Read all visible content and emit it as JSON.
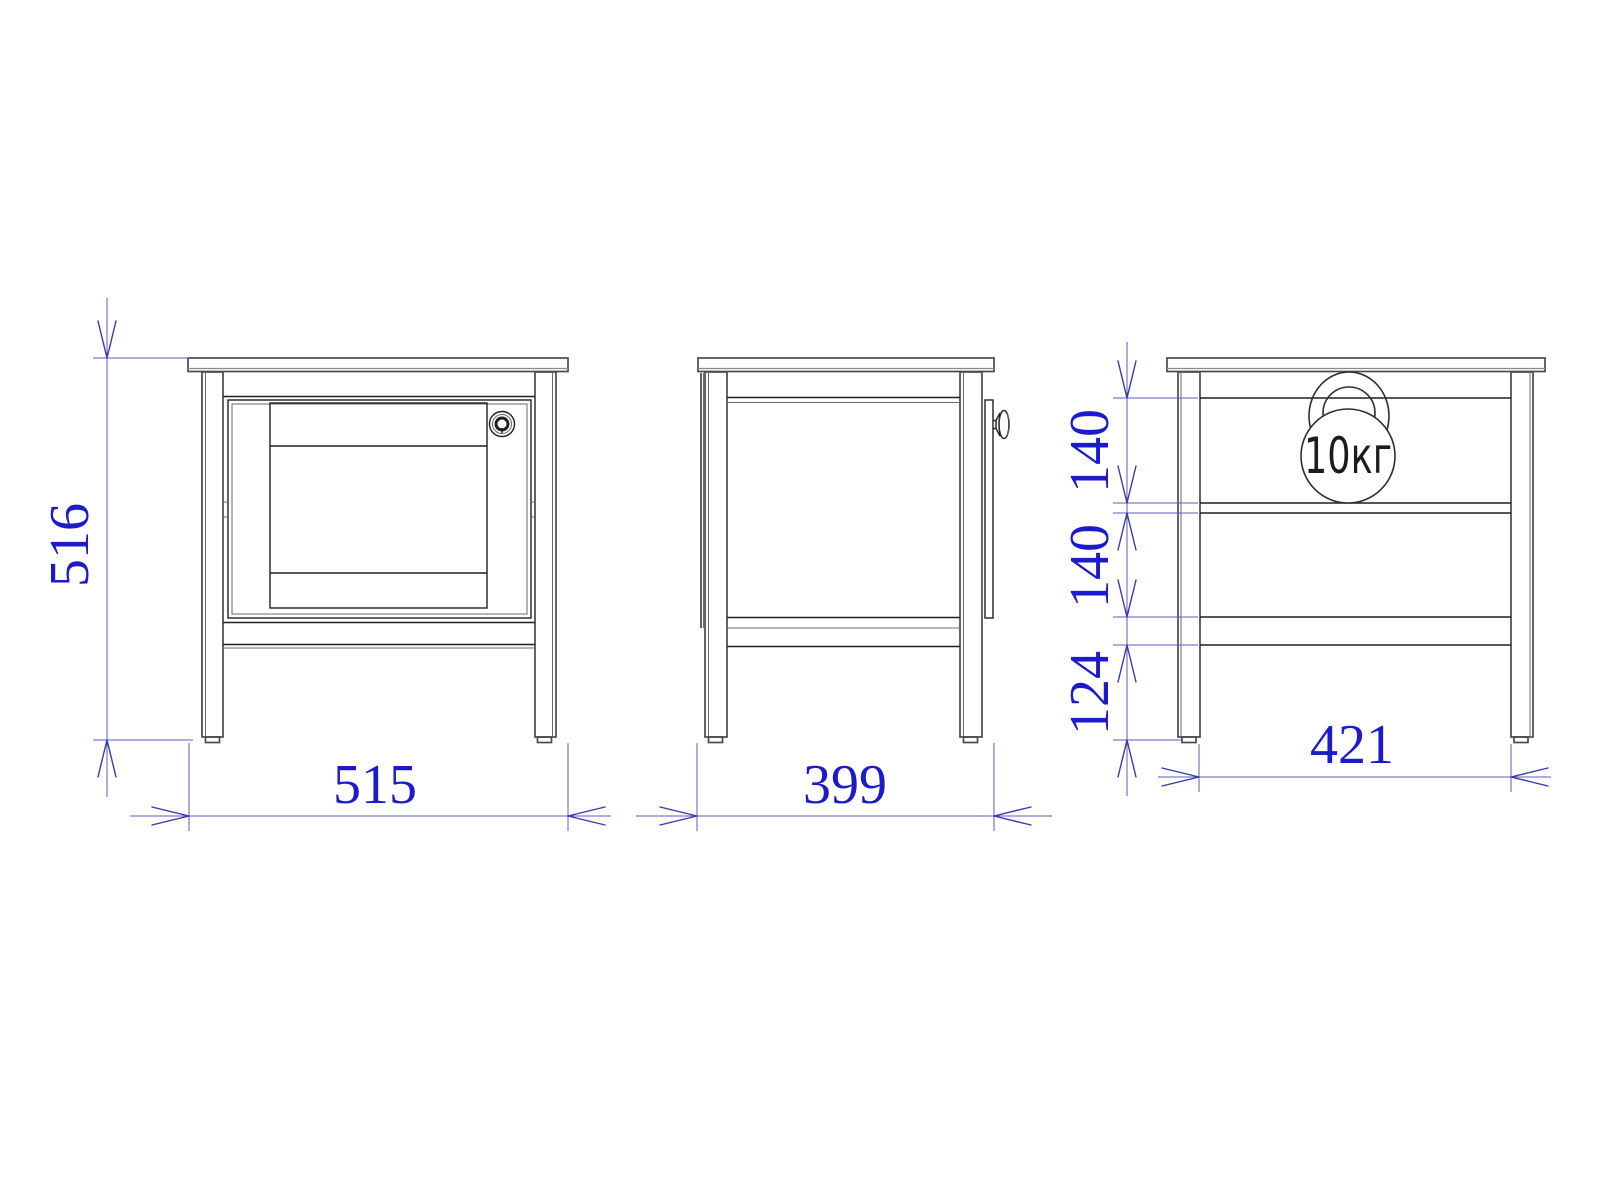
{
  "drawing": {
    "background": "#ffffff",
    "colors": {
      "dimension_text": "#1b1bcb",
      "dimension_line": "#5b5bc0",
      "object_line": "#4a4a4a"
    },
    "views": {
      "front": {
        "name": "front-view"
      },
      "side": {
        "name": "side-view"
      },
      "rear": {
        "name": "rear-view"
      }
    },
    "dimensions": {
      "height": "516",
      "width": "515",
      "depth": "399",
      "rear_top_section": "140",
      "rear_middle_section": "140",
      "rear_bottom_section": "124",
      "rear_inner_width": "421"
    },
    "load_badge": {
      "label": "10кг"
    }
  }
}
